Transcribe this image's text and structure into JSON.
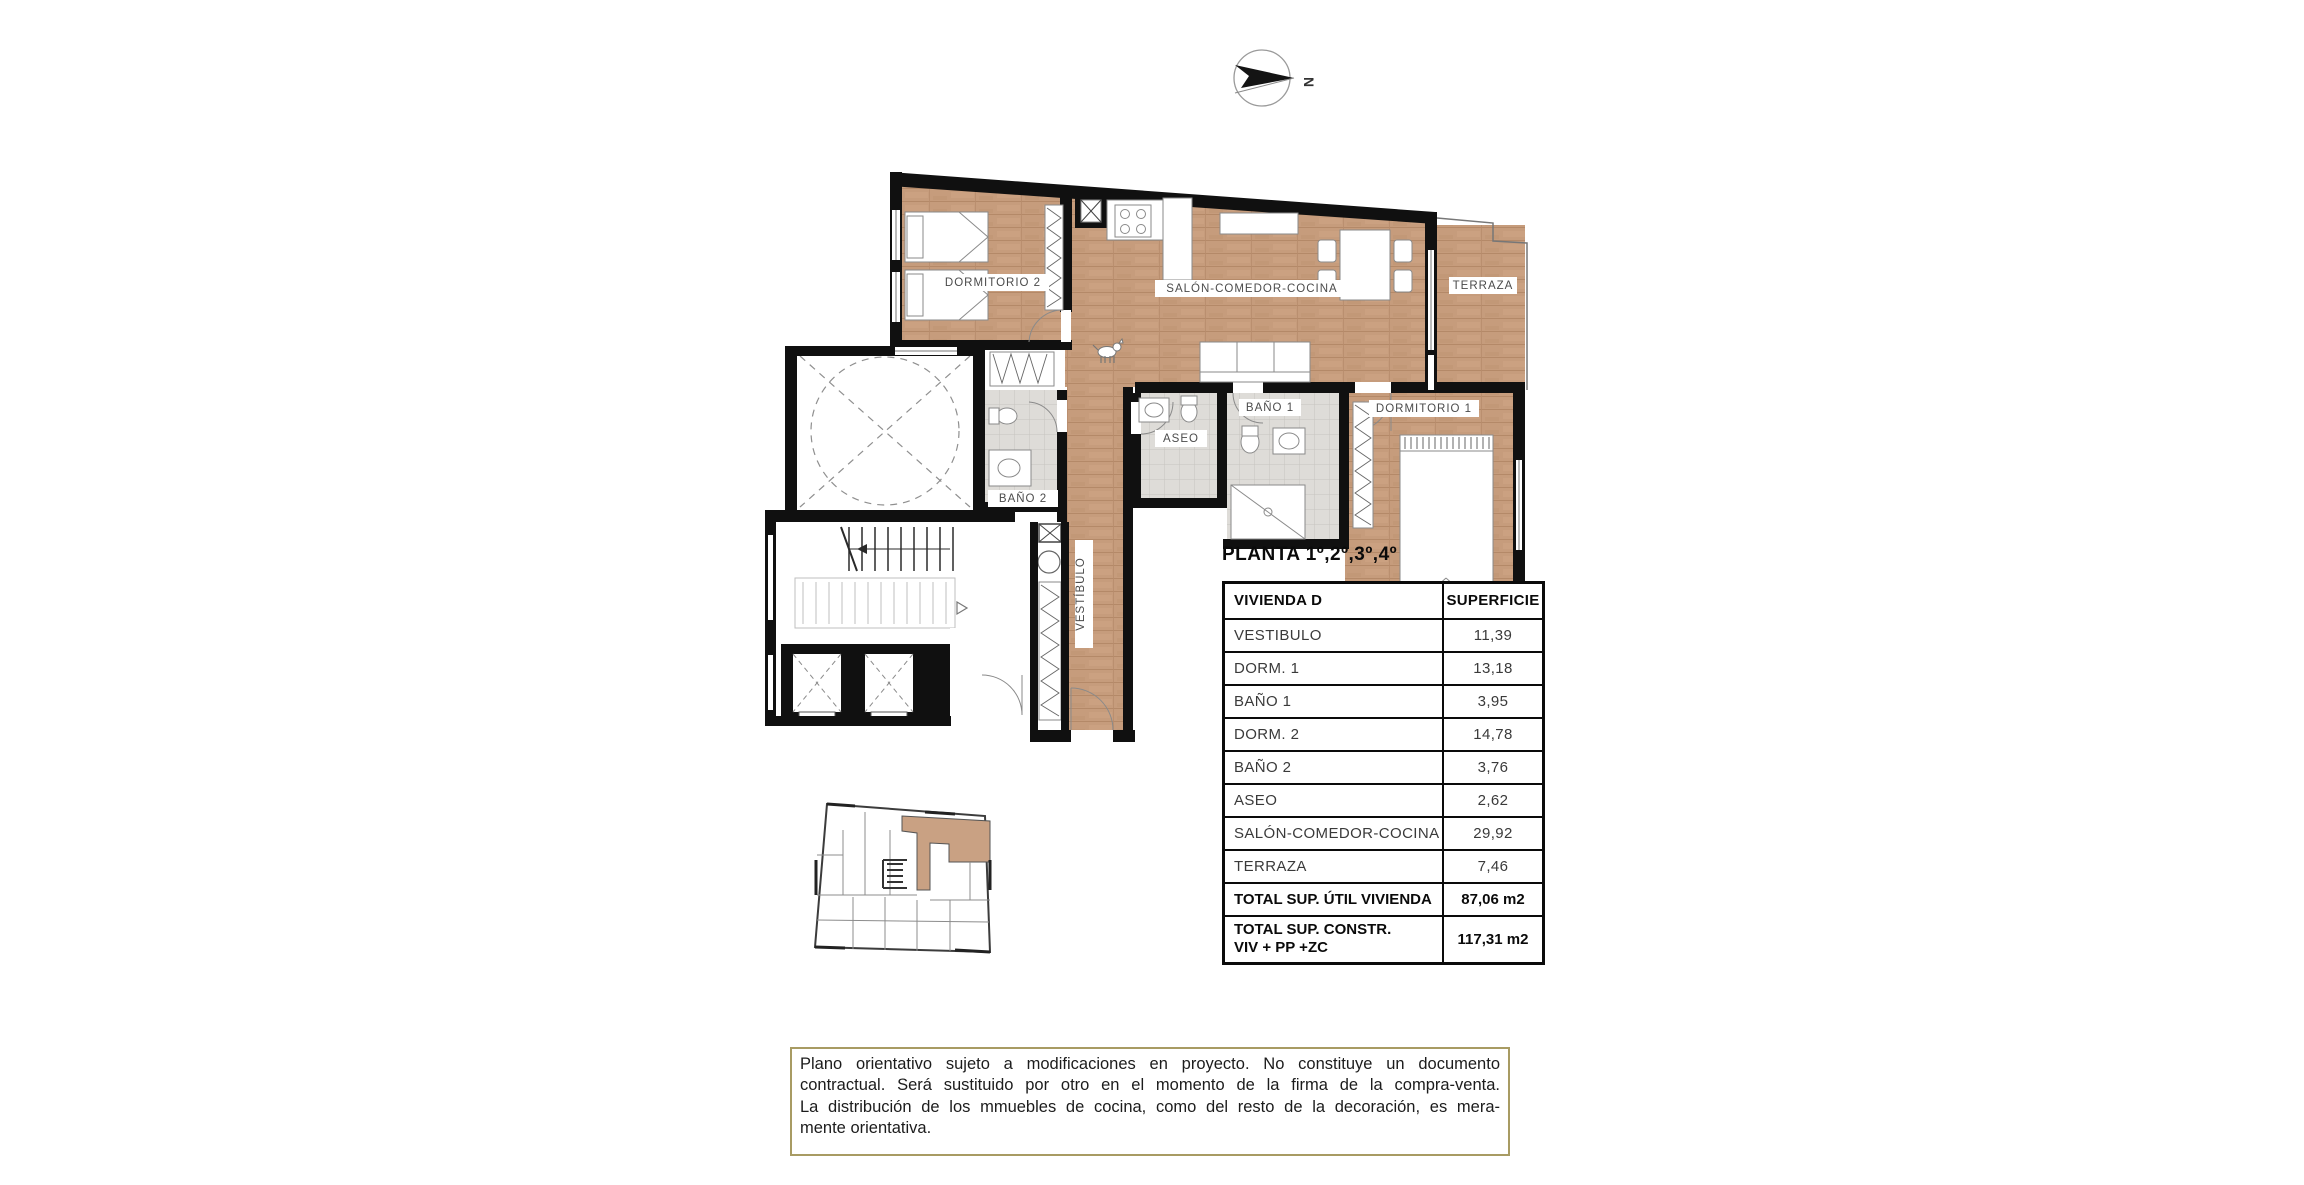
{
  "document": {
    "north_label": "N",
    "plan_title": "PLANTA 1º,2º,3º,4º"
  },
  "floor_plan": {
    "rooms": [
      {
        "label": "DORMITORIO 2"
      },
      {
        "label": "SALÓN-COMEDOR-COCINA"
      },
      {
        "label": "TERRAZA"
      },
      {
        "label": "DORMITORIO 1"
      },
      {
        "label": "BAÑO 1"
      },
      {
        "label": "ASEO"
      },
      {
        "label": "BAÑO 2"
      },
      {
        "label": "VESTÍBULO"
      }
    ],
    "colors": {
      "wood": "#c69c7c",
      "tile": "#dedcd8",
      "wall": "#101010",
      "unit_highlight": "#c9a183"
    }
  },
  "area_table": {
    "columns": [
      "VIVIENDA D",
      "SUPERFICIE"
    ],
    "rows": [
      {
        "label": "VESTIBULO",
        "value": "11,39"
      },
      {
        "label": "DORM. 1",
        "value": "13,18"
      },
      {
        "label": "BAÑO 1",
        "value": "3,95"
      },
      {
        "label": "DORM. 2",
        "value": "14,78"
      },
      {
        "label": "BAÑO 2",
        "value": "3,76"
      },
      {
        "label": "ASEO",
        "value": "2,62"
      },
      {
        "label": "SALÓN-COMEDOR-COCINA",
        "value": "29,92"
      },
      {
        "label": "TERRAZA",
        "value": "7,46"
      }
    ],
    "totals": [
      {
        "label": "TOTAL SUP. ÚTIL VIVIENDA",
        "value": "87,06 m2"
      },
      {
        "label": "TOTAL SUP. CONSTR.",
        "label2": "VIV + PP +ZC",
        "value": "117,31 m2"
      }
    ]
  },
  "disclaimer": {
    "lines": [
      "Plano orientativo sujeto a modificaciones en proyecto. No constituye un documento",
      "contractual. Será sustituido por otro en el momento de la firma de la compra-venta.",
      "La distribución de los mmuebles de cocina, como del resto de la decoración, es mera-",
      "mente orientativa."
    ]
  }
}
